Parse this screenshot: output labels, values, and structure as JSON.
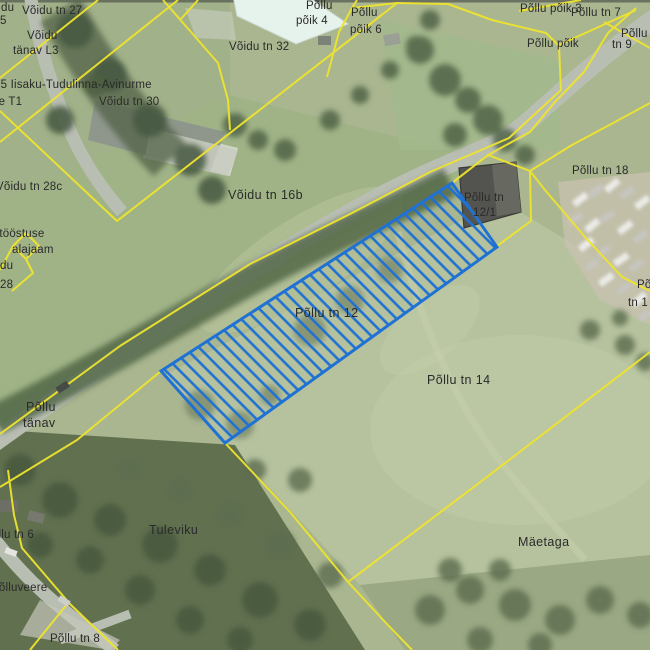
{
  "map": {
    "title": "Cadastral aerial map",
    "colors": {
      "parcel_boundary": "#eee42e",
      "highlight": "#1f72d4",
      "road": "#b9beb3",
      "field": "#a9b690",
      "forest": "#5b6b4d"
    },
    "highlight_parcel": {
      "label": "Põllu tn 12",
      "style": "blue diagonal hatch"
    },
    "labels": [
      {
        "text": "du"
      },
      {
        "text": "5"
      },
      {
        "text": "Võidu tn 27"
      },
      {
        "text": "Võidu"
      },
      {
        "text": "tänav L3"
      },
      {
        "text": "35 Iisaku-Tudulinna-Avinurme"
      },
      {
        "text": "ee T1"
      },
      {
        "text": "Võidu tn 30"
      },
      {
        "text": "Põllu"
      },
      {
        "text": "põik 4"
      },
      {
        "text": "Põllu"
      },
      {
        "text": "põik 6"
      },
      {
        "text": "Võidu tn 32"
      },
      {
        "text": "Põllu põik 3"
      },
      {
        "text": "Põllu tn 7"
      },
      {
        "text": "Põllu"
      },
      {
        "text": "Põllu põik"
      },
      {
        "text": "tn 9"
      },
      {
        "text": "Võidu tn 28c"
      },
      {
        "text": "õitööstuse"
      },
      {
        "text": "alajaam"
      },
      {
        "text": "du"
      },
      {
        "text": "28"
      },
      {
        "text": "Võidu tn 16b"
      },
      {
        "text": "Põllu tn 18"
      },
      {
        "text": "Põllu tn"
      },
      {
        "text": "12/1"
      },
      {
        "text": "Põllu tn 12"
      },
      {
        "text": "Põllu tn 14"
      },
      {
        "text": "Põ"
      },
      {
        "text": "tn 1"
      },
      {
        "text": "Põllu"
      },
      {
        "text": "tänav"
      },
      {
        "text": "Tuleviku"
      },
      {
        "text": "Põllu tn 6"
      },
      {
        "text": "Põlluveere"
      },
      {
        "text": "Põllu tn 8"
      },
      {
        "text": "Mäetaga"
      }
    ]
  }
}
